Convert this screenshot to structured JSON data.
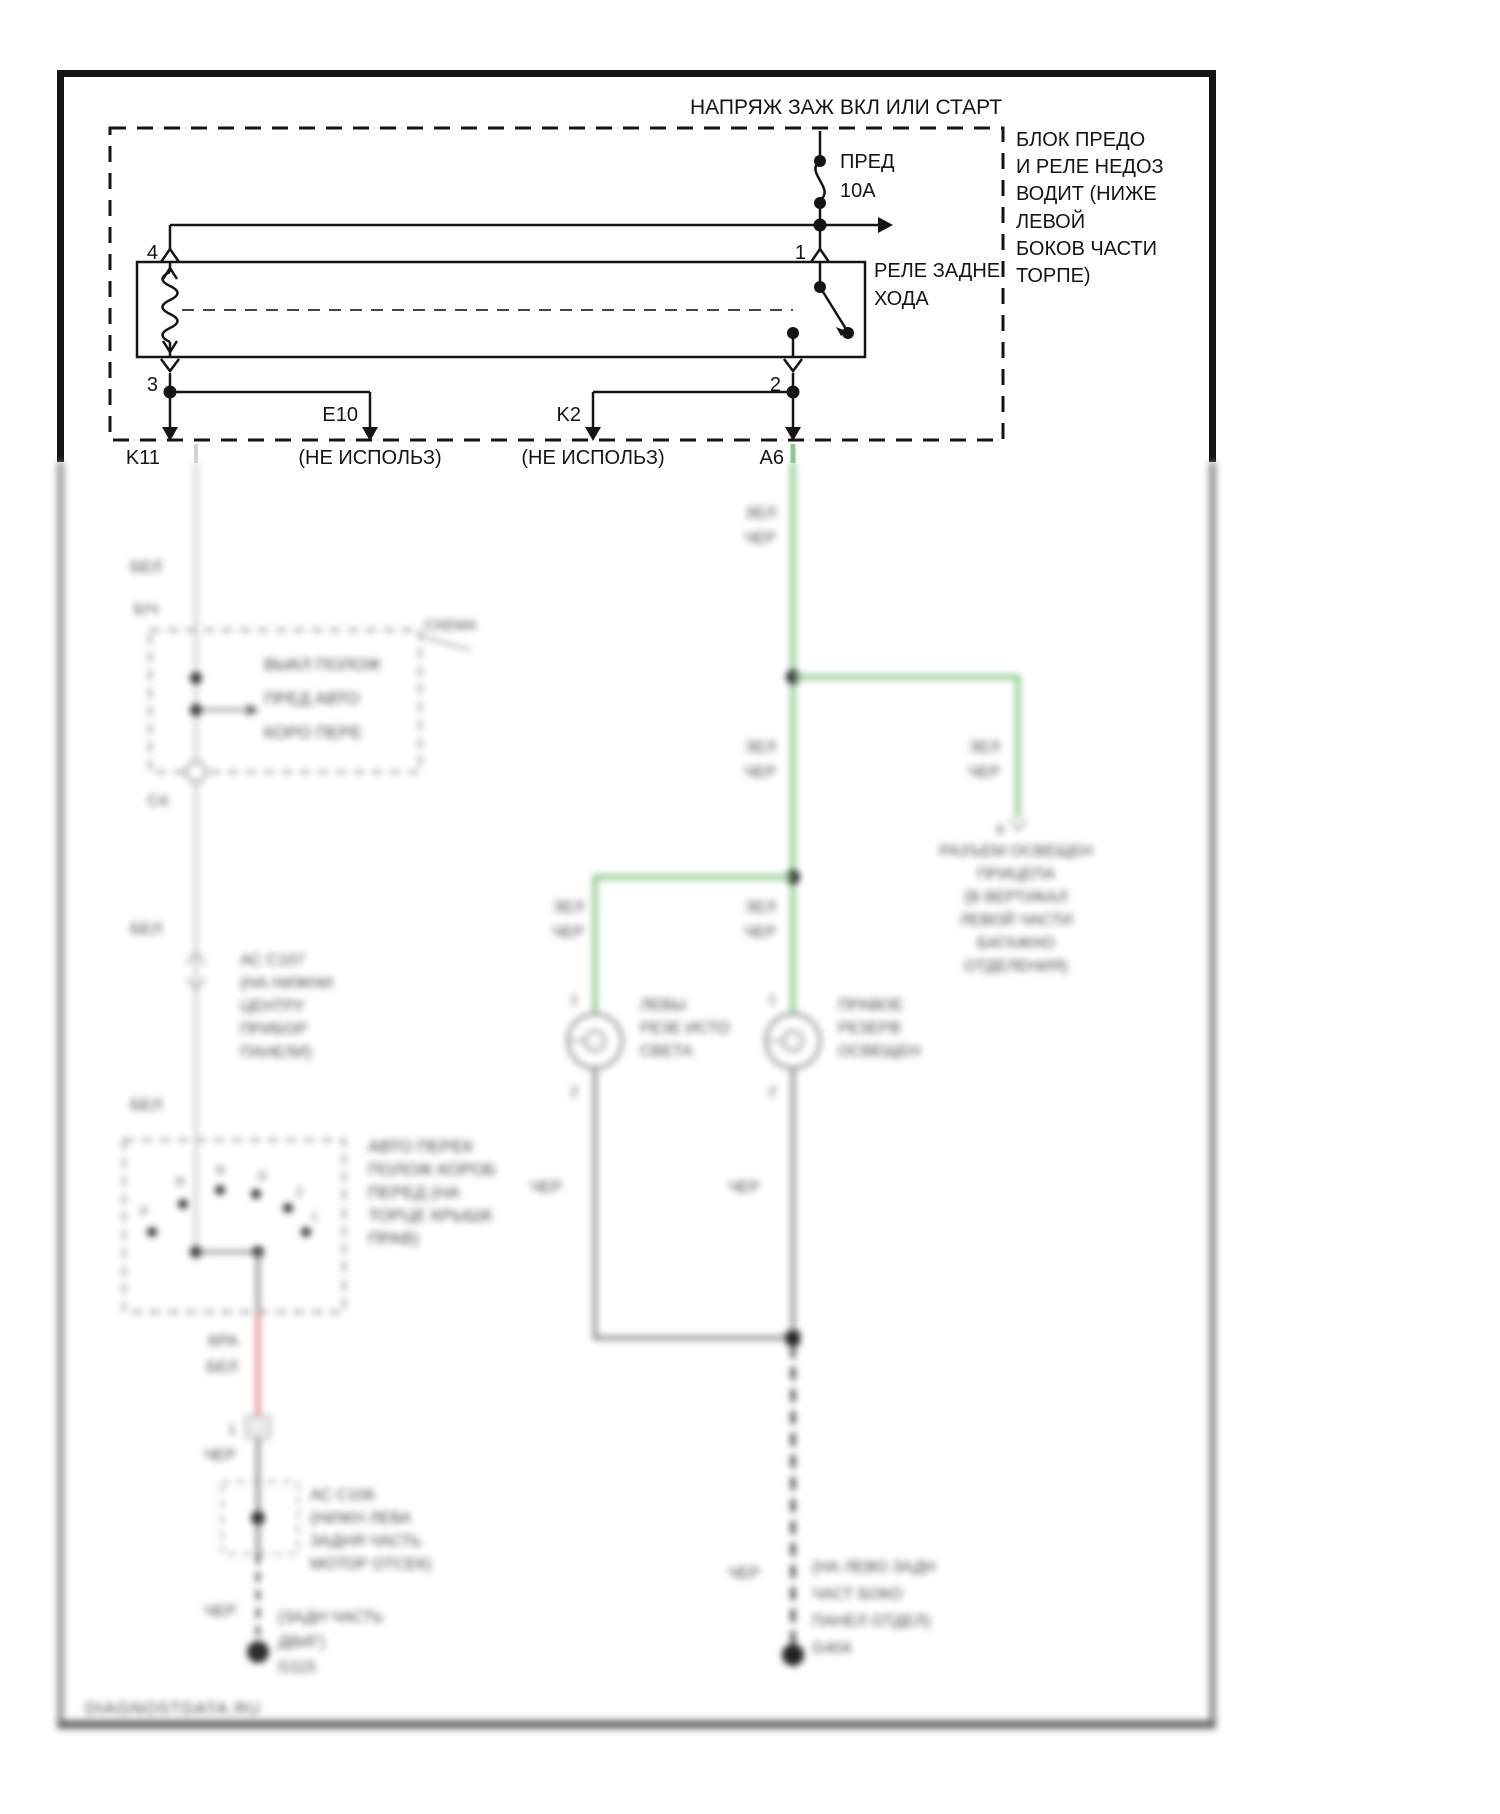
{
  "top": {
    "title": "НАПРЯЖ ЗАЖ ВКЛ ИЛИ СТАРТ",
    "fuse": {
      "name": "ПРЕД",
      "rating": "10А"
    },
    "block_note": {
      "lines": [
        "БЛОК ПРЕДО",
        "И РЕЛЕ НЕДОЗ",
        "ВОДИТ (НИЖЕ",
        "ЛЕВОЙ",
        "БОКОВ ЧАСТИ",
        "ТОРПЕ)"
      ]
    },
    "relay": {
      "name1": "РЕЛЕ ЗАДНЕ",
      "name2": "ХОДА",
      "pin1": "1",
      "pin2": "2",
      "pin3": "3",
      "pin4": "4"
    },
    "exits": {
      "k11": "K11",
      "e10": "E10",
      "e10_note": "(НЕ ИСПОЛЬЗ)",
      "k2": "K2",
      "k2_note": "(НЕ ИСПОЛЬЗ)",
      "a6": "A6"
    }
  },
  "left": {
    "w1": "БЕЛ",
    "w2": "Б/Ч",
    "w3": "БЕЛ",
    "w4": "БЕЛ",
    "inhibitor": {
      "ext": "СХЕМА",
      "lines": [
        "ВЫКЛ ПОЛОЖ",
        "ПРЕД АВТО",
        "КОРО ПЕРЕ"
      ],
      "connector": "С4"
    },
    "c107": {
      "lines": [
        "АС С107",
        "(НА НИЖНИ",
        "ЦЕНТРУ",
        "ПРИБОР",
        "ПАНЕЛИ)"
      ]
    },
    "range": {
      "positions": [
        "Р",
        "R",
        "N",
        "D",
        "2",
        "L"
      ],
      "note": [
        "АВТО ПЕРЕК",
        "ПОЛОЖ КОРОБ",
        "ПЕРЕД (НА",
        "ТОРЦЕ КРЫШК",
        "ПРАВ)"
      ]
    },
    "red1": "КРА",
    "red2": "БЕЛ",
    "pin1": "1",
    "blk1": "ЧЕР",
    "c106": {
      "lines": [
        "АС С106",
        "(НИЖН ЛЕВА",
        "ЗАДНЯ ЧАСТЬ",
        "МОТОР ОТСЕК)"
      ]
    },
    "blk2": "ЧЕР",
    "ground": {
      "lines": [
        "(ЗАДН ЧАСТЬ",
        "ДВИГ)",
        "G115"
      ]
    }
  },
  "right": {
    "gl": "ЗЕЛ",
    "gb": "ЧЕР",
    "trailer": {
      "pin": "6",
      "lines": [
        "РАЗЪЕМ ОСВЕЩЕН",
        "ПРИЦЕПА",
        "(В ВЕРТИКАЛ",
        "ЛЕВОЙ ЧАСТИ",
        "БАГАЖНО",
        "ОТДЕЛЕНИЯ)"
      ]
    },
    "pin_top": "1",
    "pin_bottom": "2",
    "lamp_l": {
      "lines": [
        "ЛЕВЫ",
        "РЕЗЕ ИСТО",
        "СВЕТА"
      ]
    },
    "lamp_r": {
      "lines": [
        "ПРАВОЕ",
        "РЕЗЕРВ",
        "ОСВЕЩЕН"
      ]
    },
    "blk": "ЧЕР",
    "ground": {
      "lines": [
        "(НА ЛЕВО ЗАДН",
        "ЧАСТ БОКО",
        "ПАНЕЛ ОТДЕЛ)",
        "G404"
      ]
    }
  },
  "watermark": "DIAGNOSTDATA.RU",
  "colors": {
    "green": "#8cc98c",
    "red": "#e59090",
    "gray": "#909090",
    "light": "#d2d2d2",
    "dark": "#3f3f3f"
  }
}
